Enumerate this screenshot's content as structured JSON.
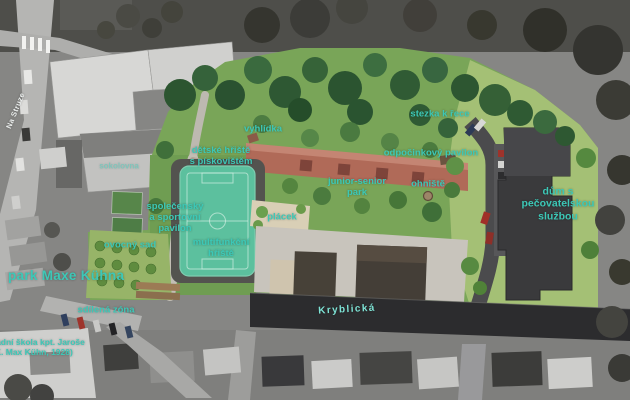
{
  "colors": {
    "accent": "#3cc8b7",
    "street_label": "#ecefee",
    "kryblicka_label": "#7fe4d6",
    "court_teal": "#5cc09e",
    "terrace_red": "#b06a58",
    "park_green": "#79a558"
  },
  "labels": {
    "na_struze": {
      "text": "Na Struze"
    },
    "sokolovna": {
      "text": "sokolovna"
    },
    "vyhlidka": {
      "text": "vyhlídka"
    },
    "stezka_k_rece": {
      "text": "stezka k řece"
    },
    "detske_hriste": {
      "text": "dětské hřiště\ns pískovištěm"
    },
    "odpocinkovy_pavilon": {
      "text": "odpočinkový pavilon"
    },
    "junior_senior_park": {
      "text": "junior-senior\npark"
    },
    "ohniste": {
      "text": "ohniště"
    },
    "dum_s_pecovatelskou": {
      "text": "dům s pečovatelskou\nslužbou"
    },
    "spolecensky_pavilon": {
      "text": "společenský\na sportovní\npavilon"
    },
    "placek": {
      "text": "plácek"
    },
    "ovocny_sad": {
      "text": "ovocný sad"
    },
    "multifunkcni_hriste": {
      "text": "multifunkční\nhřiště"
    },
    "park_maxe_kuhna": {
      "text": "park Maxe Kühna"
    },
    "sdilena_zona": {
      "text": "sdílená zóna"
    },
    "skola": {
      "text": "základní škola kpt. Jaroše\n(K. Max Kühn, 1928)"
    },
    "kryblicka": {
      "text": "Kryblická"
    }
  }
}
